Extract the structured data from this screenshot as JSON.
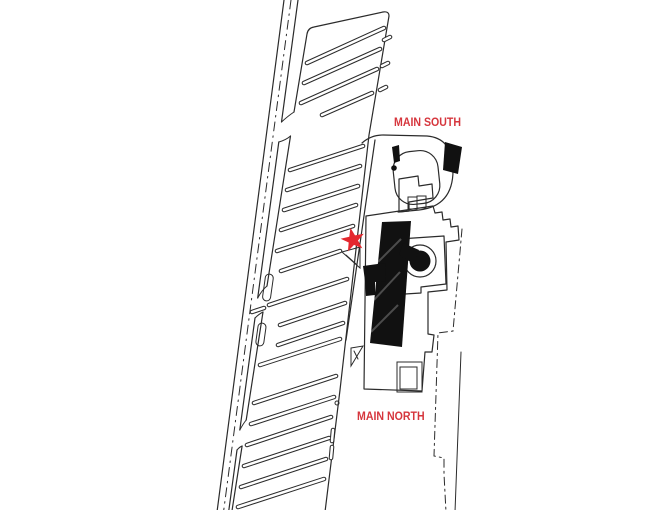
{
  "map": {
    "type": "site-map",
    "labels": [
      {
        "id": "main-south",
        "text": "MAIN SOUTH"
      },
      {
        "id": "main-north",
        "text": "MAIN NORTH"
      }
    ],
    "marker": {
      "icon": "star-icon",
      "shape": "5-point-star",
      "color": "#e4272e"
    },
    "colors": {
      "label_red": "#d6363d",
      "line_black": "#2b2b2b",
      "fill_black": "#111111",
      "background": "#ffffff"
    }
  }
}
